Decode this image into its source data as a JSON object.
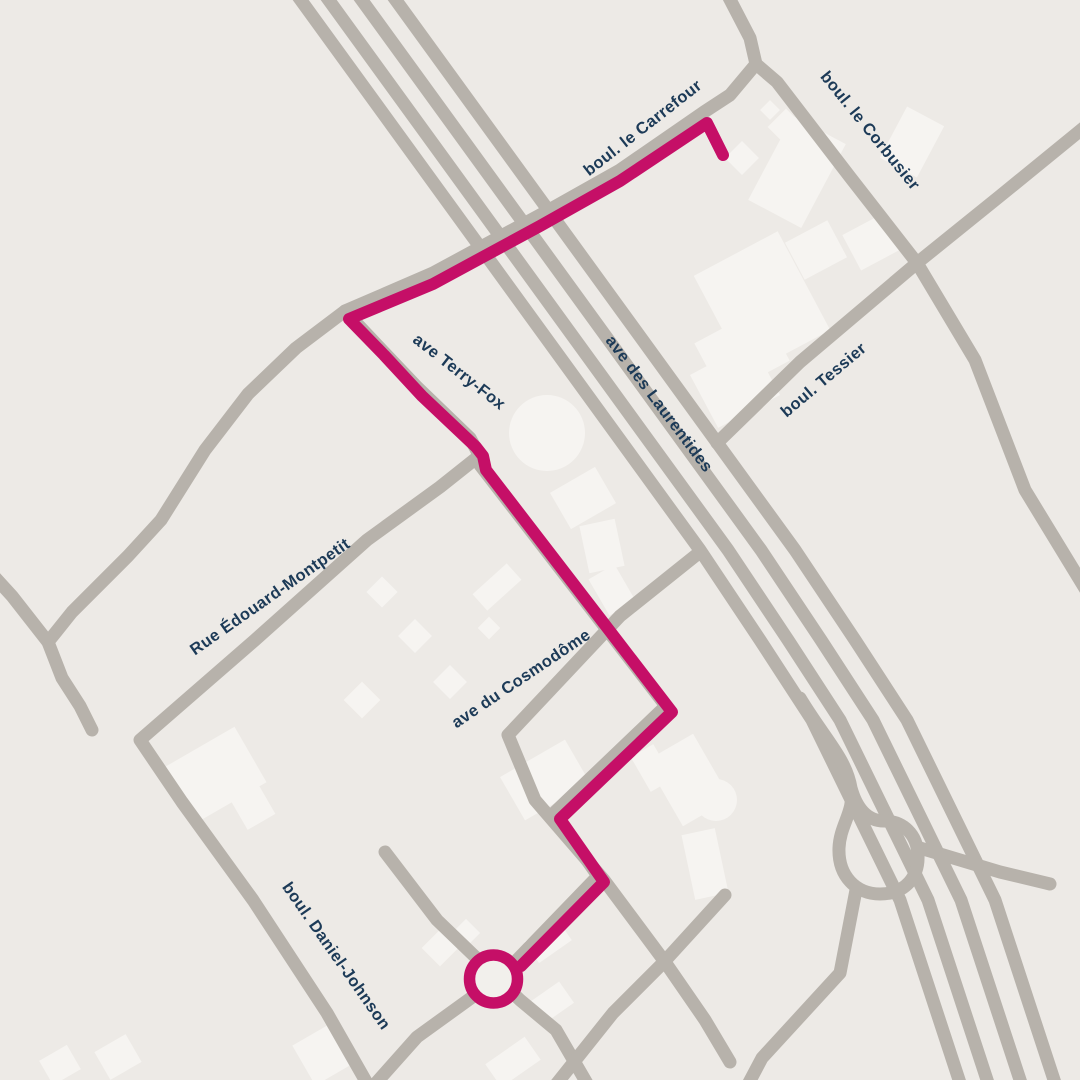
{
  "map": {
    "title": "Route map",
    "colors": {
      "background": "#edeae6",
      "road": "#b7b2ab",
      "building": "#f6f4f1",
      "route": "#c50f67",
      "roundabout_fill": "#f2f0ec",
      "label": "#1c3a57"
    },
    "labels": [
      {
        "name": "boul-le-carrefour",
        "text": "boul. le Carrefour",
        "x": 646,
        "y": 132,
        "rotation": -38
      },
      {
        "name": "boul-le-corbusier",
        "text": "boul. le Corbusier",
        "x": 866,
        "y": 134,
        "rotation": 51
      },
      {
        "name": "ave-des-laurentides",
        "text": "ave des Laurentides",
        "x": 655,
        "y": 407,
        "rotation": 53
      },
      {
        "name": "boul-tessier",
        "text": "boul. Tessier",
        "x": 827,
        "y": 384,
        "rotation": -40
      },
      {
        "name": "ave-terry-fox",
        "text": "ave Terry-Fox",
        "x": 456,
        "y": 376,
        "rotation": 38
      },
      {
        "name": "rue-edouard-montpetit",
        "text": "Rue Édouard-Montpetit",
        "x": 273,
        "y": 601,
        "rotation": -35
      },
      {
        "name": "ave-du-cosmodome",
        "text": "ave du Cosmodôme",
        "x": 524,
        "y": 683,
        "rotation": -34
      },
      {
        "name": "boul-daniel-johnson",
        "text": "boul. Daniel-Johnson",
        "x": 332,
        "y": 959,
        "rotation": 55
      }
    ],
    "roads": [
      {
        "name": "laurentides-lane-1",
        "width": 13,
        "points": [
          [
            292,
            -12
          ],
          [
            700,
            550
          ],
          [
            760,
            640
          ],
          [
            812,
            720
          ],
          [
            900,
            900
          ],
          [
            963,
            1092
          ]
        ]
      },
      {
        "name": "laurentides-lane-2",
        "width": 13,
        "points": [
          [
            320,
            -12
          ],
          [
            728,
            550
          ],
          [
            788,
            640
          ],
          [
            840,
            720
          ],
          [
            928,
            900
          ],
          [
            991,
            1092
          ]
        ]
      },
      {
        "name": "laurentides-lane-3",
        "width": 13,
        "points": [
          [
            353,
            -12
          ],
          [
            761,
            550
          ],
          [
            821,
            640
          ],
          [
            873,
            720
          ],
          [
            961,
            900
          ],
          [
            1024,
            1092
          ]
        ]
      },
      {
        "name": "laurentides-lane-4",
        "width": 13,
        "points": [
          [
            387,
            -12
          ],
          [
            795,
            550
          ],
          [
            855,
            640
          ],
          [
            907,
            720
          ],
          [
            995,
            900
          ],
          [
            1058,
            1092
          ]
        ]
      },
      {
        "name": "carrefour-north-stub",
        "width": 13,
        "points": [
          [
            724,
            -12
          ],
          [
            750,
            38
          ],
          [
            756,
            64
          ]
        ]
      },
      {
        "name": "boul-le-corbusier",
        "width": 13,
        "points": [
          [
            756,
            64
          ],
          [
            777,
            82
          ],
          [
            850,
            177
          ],
          [
            917,
            263
          ],
          [
            975,
            360
          ],
          [
            1025,
            490
          ],
          [
            1092,
            600
          ]
        ]
      },
      {
        "name": "boul-le-carrefour",
        "width": 13,
        "points": [
          [
            756,
            64
          ],
          [
            730,
            95
          ],
          [
            704,
            112
          ],
          [
            620,
            170
          ],
          [
            540,
            215
          ],
          [
            433,
            273
          ],
          [
            345,
            311
          ],
          [
            296,
            348
          ],
          [
            248,
            394
          ],
          [
            205,
            450
          ],
          [
            161,
            520
          ],
          [
            128,
            556
          ],
          [
            72,
            612
          ],
          [
            48,
            642
          ],
          [
            62,
            678
          ],
          [
            80,
            706
          ],
          [
            92,
            730
          ]
        ]
      },
      {
        "name": "carrefour-west-arm",
        "width": 13,
        "points": [
          [
            -10,
            572
          ],
          [
            12,
            596
          ],
          [
            48,
            642
          ]
        ]
      },
      {
        "name": "boul-tessier",
        "width": 13,
        "points": [
          [
            717,
            443
          ],
          [
            800,
            362
          ],
          [
            917,
            263
          ],
          [
            1000,
            196
          ],
          [
            1092,
            121
          ]
        ]
      },
      {
        "name": "ave-terry-fox",
        "width": 13,
        "points": [
          [
            345,
            311
          ],
          [
            378,
            346
          ],
          [
            416,
            386
          ],
          [
            470,
            438
          ],
          [
            477,
            451
          ],
          [
            480,
            465
          ],
          [
            666,
            706
          ],
          [
            554,
            813
          ],
          [
            598,
            876
          ],
          [
            516,
            961
          ]
        ]
      },
      {
        "name": "ave-du-cosmodome",
        "width": 13,
        "points": [
          [
            700,
            552
          ],
          [
            620,
            616
          ],
          [
            508,
            735
          ],
          [
            535,
            800
          ],
          [
            604,
            880
          ],
          [
            665,
            962
          ],
          [
            705,
            1020
          ],
          [
            730,
            1062
          ]
        ]
      },
      {
        "name": "montpetit-daniel-johnson",
        "width": 13,
        "points": [
          [
            479,
            456
          ],
          [
            440,
            487
          ],
          [
            367,
            540
          ],
          [
            255,
            640
          ],
          [
            140,
            740
          ],
          [
            182,
            802
          ],
          [
            253,
            900
          ],
          [
            327,
            1013
          ],
          [
            372,
            1092
          ]
        ]
      },
      {
        "name": "roundabout-road-nw-se",
        "width": 13,
        "points": [
          [
            385,
            852
          ],
          [
            437,
            920
          ],
          [
            520,
            1000
          ],
          [
            556,
            1030
          ],
          [
            592,
            1092
          ]
        ]
      },
      {
        "name": "roundabout-road-sw",
        "width": 13,
        "points": [
          [
            368,
            1092
          ],
          [
            417,
            1037
          ],
          [
            518,
            964
          ]
        ]
      },
      {
        "name": "crossing-road-se",
        "width": 13,
        "points": [
          [
            725,
            895
          ],
          [
            663,
            963
          ],
          [
            613,
            1013
          ],
          [
            550,
            1092
          ]
        ]
      },
      {
        "name": "ramp-road-east",
        "width": 13,
        "points": [
          [
            1050,
            884
          ],
          [
            1000,
            872
          ],
          [
            920,
            848
          ]
        ]
      },
      {
        "name": "ramp-road-south",
        "width": 13,
        "points": [
          [
            856,
            890
          ],
          [
            840,
            973
          ],
          [
            762,
            1058
          ],
          [
            744,
            1092
          ]
        ]
      }
    ],
    "ramp_loop": {
      "name": "highway-loop-ramp",
      "width": 13,
      "path": "M 800 698 C 824 738 846 758 851 788 C 855 812 840 824 839 848 C 838 876 856 894 880 894 C 906 894 919 876 918 855 C 917 834 903 821 884 821 C 866 821 856 806 851 788"
    },
    "route": {
      "width": 12,
      "points": [
        [
          723,
          155
        ],
        [
          707,
          123
        ],
        [
          620,
          181
        ],
        [
          540,
          226
        ],
        [
          433,
          284
        ],
        [
          349,
          319
        ],
        [
          384,
          355
        ],
        [
          422,
          396
        ],
        [
          476,
          447
        ],
        [
          483,
          456
        ],
        [
          486,
          470
        ],
        [
          672,
          712
        ],
        [
          560,
          819
        ],
        [
          604,
          882
        ],
        [
          521,
          966
        ]
      ],
      "roundabout": {
        "cx": 493.5,
        "cy": 979,
        "r": 24,
        "stroke_width": 11.5
      }
    },
    "buildings": {
      "rects": [
        [
          912,
          142,
          42,
          58,
          28
        ],
        [
          797,
          172,
          60,
          95,
          28
        ],
        [
          872,
          242,
          46,
          40,
          -28
        ],
        [
          762,
          303,
          95,
          112,
          -28
        ],
        [
          816,
          250,
          48,
          42,
          -28
        ],
        [
          742,
          352,
          76,
          60,
          -28
        ],
        [
          735,
          385,
          70,
          60,
          -28
        ],
        [
          583,
          498,
          52,
          42,
          -30
        ],
        [
          602,
          546,
          36,
          48,
          -12
        ],
        [
          612,
          590,
          30,
          42,
          -30
        ],
        [
          497,
          587,
          46,
          22,
          -42
        ],
        [
          215,
          775,
          82,
          64,
          -30
        ],
        [
          250,
          802,
          32,
          46,
          -30
        ],
        [
          322,
          1055,
          42,
          46,
          -30
        ],
        [
          118,
          1057,
          36,
          32,
          -30
        ],
        [
          60,
          1065,
          32,
          28,
          -30
        ],
        [
          688,
          780,
          55,
          75,
          -30
        ],
        [
          705,
          864,
          34,
          66,
          -12
        ],
        [
          652,
          768,
          26,
          40,
          -30
        ],
        [
          545,
          780,
          75,
          50,
          -30
        ],
        [
          548,
          941,
          40,
          26,
          -35
        ],
        [
          551,
          1003,
          38,
          26,
          -35
        ],
        [
          513,
          1062,
          48,
          28,
          -35
        ]
      ],
      "diamonds": [
        [
          786,
          127,
          26
        ],
        [
          770,
          110,
          14
        ],
        [
          742,
          158,
          24
        ],
        [
          382,
          592,
          22
        ],
        [
          415,
          636,
          24
        ],
        [
          450,
          682,
          24
        ],
        [
          489,
          628,
          16
        ],
        [
          362,
          700,
          26
        ],
        [
          440,
          948,
          26
        ],
        [
          466,
          933,
          20
        ]
      ],
      "circles": [
        [
          547,
          433,
          38
        ],
        [
          716,
          800,
          21
        ]
      ]
    }
  }
}
